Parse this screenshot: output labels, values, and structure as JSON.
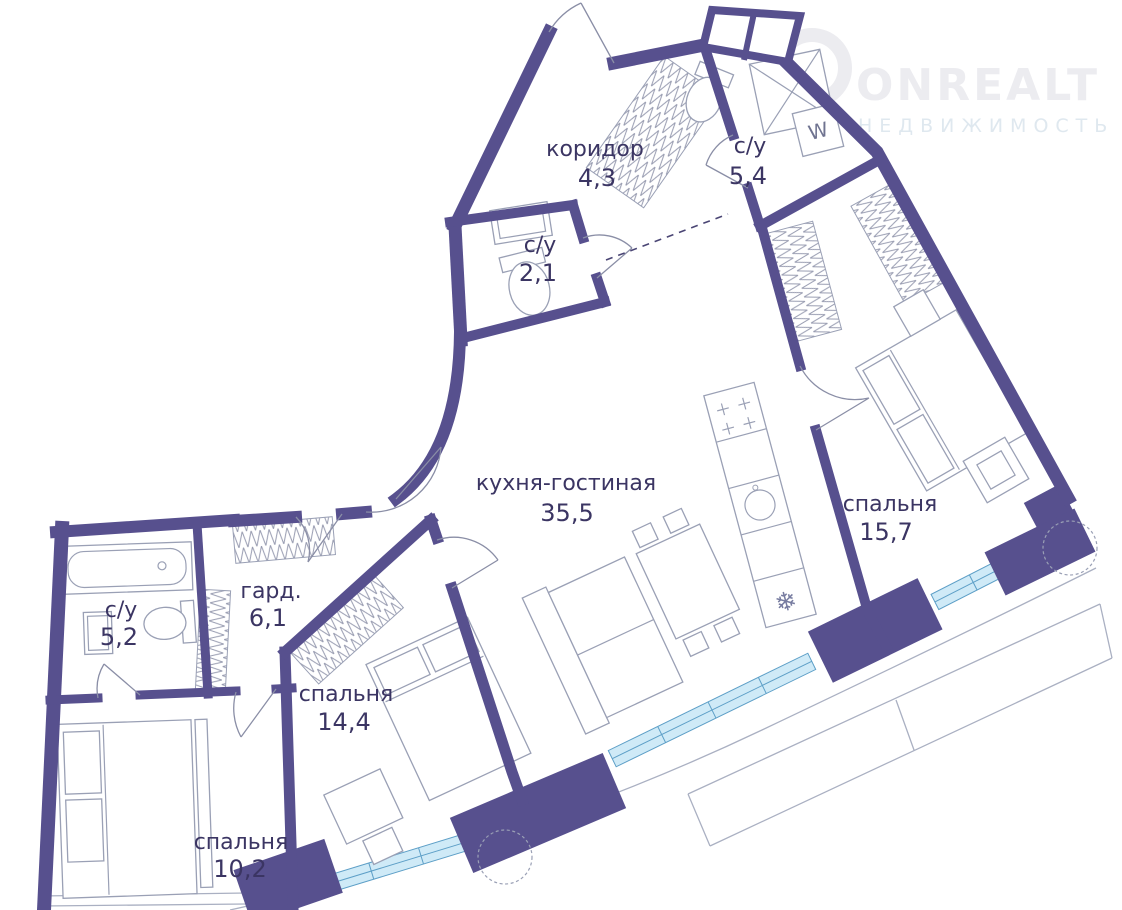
{
  "plan": {
    "type": "apartment-floor-plan",
    "rooms": [
      {
        "name": "коридор",
        "area": "4,3"
      },
      {
        "name": "с/у",
        "area": "5,4"
      },
      {
        "name": "с/у",
        "area": "2,1"
      },
      {
        "name": "кухня-гостиная",
        "area": "35,5"
      },
      {
        "name": "спальня",
        "area": "15,7"
      },
      {
        "name": "гард.",
        "area": "6,1"
      },
      {
        "name": "с/у",
        "area": "5,2"
      },
      {
        "name": "спальня",
        "area": "14,4"
      },
      {
        "name": "спальня",
        "area": "10,2"
      }
    ],
    "symbols": {
      "washer": "W",
      "fridge": "❄"
    }
  },
  "watermark": {
    "brand": "ONREALT",
    "subtitle": "НЕДВИЖИМОСТЬ"
  },
  "colors": {
    "wall": "#57508e",
    "window_fill": "#cfeaf7",
    "window_frame": "#5d9fc7",
    "furniture_line": "#9aa0b5",
    "label_text": "#3b3563",
    "watermark_text": "#ececf0"
  }
}
